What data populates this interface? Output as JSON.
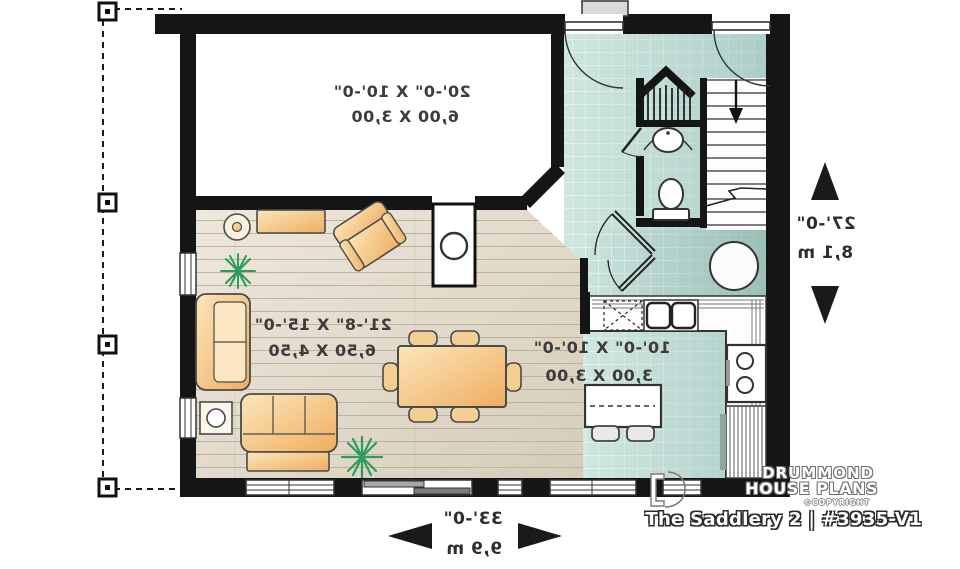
{
  "plan": {
    "mirrored_text": true,
    "rooms": [
      {
        "id": "bonus-room",
        "size_imperial": "20'-0\" X 10'-0\"",
        "size_metric": "6,00 X 3,00"
      },
      {
        "id": "living-room",
        "size_imperial": "21'-8\" X 15'-0\"",
        "size_metric": "6,50 X 4,50"
      },
      {
        "id": "kitchen",
        "size_imperial": "10'-0\" X 10'-0\"",
        "size_metric": "3,00 X 3,00"
      }
    ],
    "overall_depth": {
      "imperial": "27'-0\"",
      "metric": "8,1 m"
    },
    "overall_width": {
      "imperial": "33'-0\"",
      "metric": "9,9 m"
    }
  },
  "branding": {
    "name_line1": "DRUMMOND",
    "name_line2": "HOUSE PLANS",
    "copyright": "©COPYRIGHT",
    "plan_title": "The Saddlery 2 | #3935-V1"
  },
  "colors": {
    "wall": "#151515",
    "tile_floor": "#cee6e0",
    "wood_floor": "#e7dfd1",
    "furniture": "#f2c27c",
    "plant": "#2d9c5e"
  }
}
